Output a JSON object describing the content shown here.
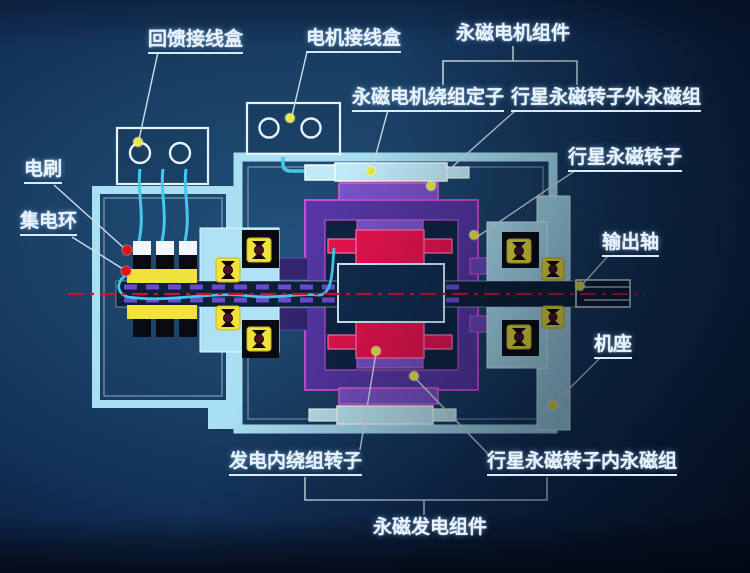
{
  "diagram": {
    "type": "permanent-magnet-motor-generator-cross-section",
    "labels": {
      "feedback_junction_box": "回馈接线盒",
      "motor_junction_box": "电机接线盒",
      "pm_motor_assembly": "永磁电机组件",
      "pm_motor_winding_stator": "永磁电机绕组定子",
      "planetary_rotor_outer_pm_group": "行星永磁转子外永磁组",
      "planetary_pm_rotor": "行星永磁转子",
      "output_shaft": "输出轴",
      "machine_frame": "机座",
      "brush": "电刷",
      "slip_ring": "集电环",
      "generator_inner_winding_rotor": "发电内绕组转子",
      "planetary_rotor_inner_pm_group": "行星永磁转子内永磁组",
      "pm_generator_assembly": "永磁发电组件"
    },
    "colors": {
      "background_blue": "#1a4065",
      "housing_cyan": "#a8dff2",
      "stator_cyan": "#bfeaf6",
      "rotor_purple": "#5536a2",
      "pm_violet": "#7a52c8",
      "magenta_outline": "#cc4bd6",
      "winding_red": "#e8134e",
      "slipring_yellow": "#f0e13c",
      "wire_cyan": "#46c8ec",
      "centerline_red": "#cc1130",
      "marker_yellow": "#eae83e",
      "marker_red": "#de1015",
      "label_white": "#e9f2fb"
    }
  }
}
